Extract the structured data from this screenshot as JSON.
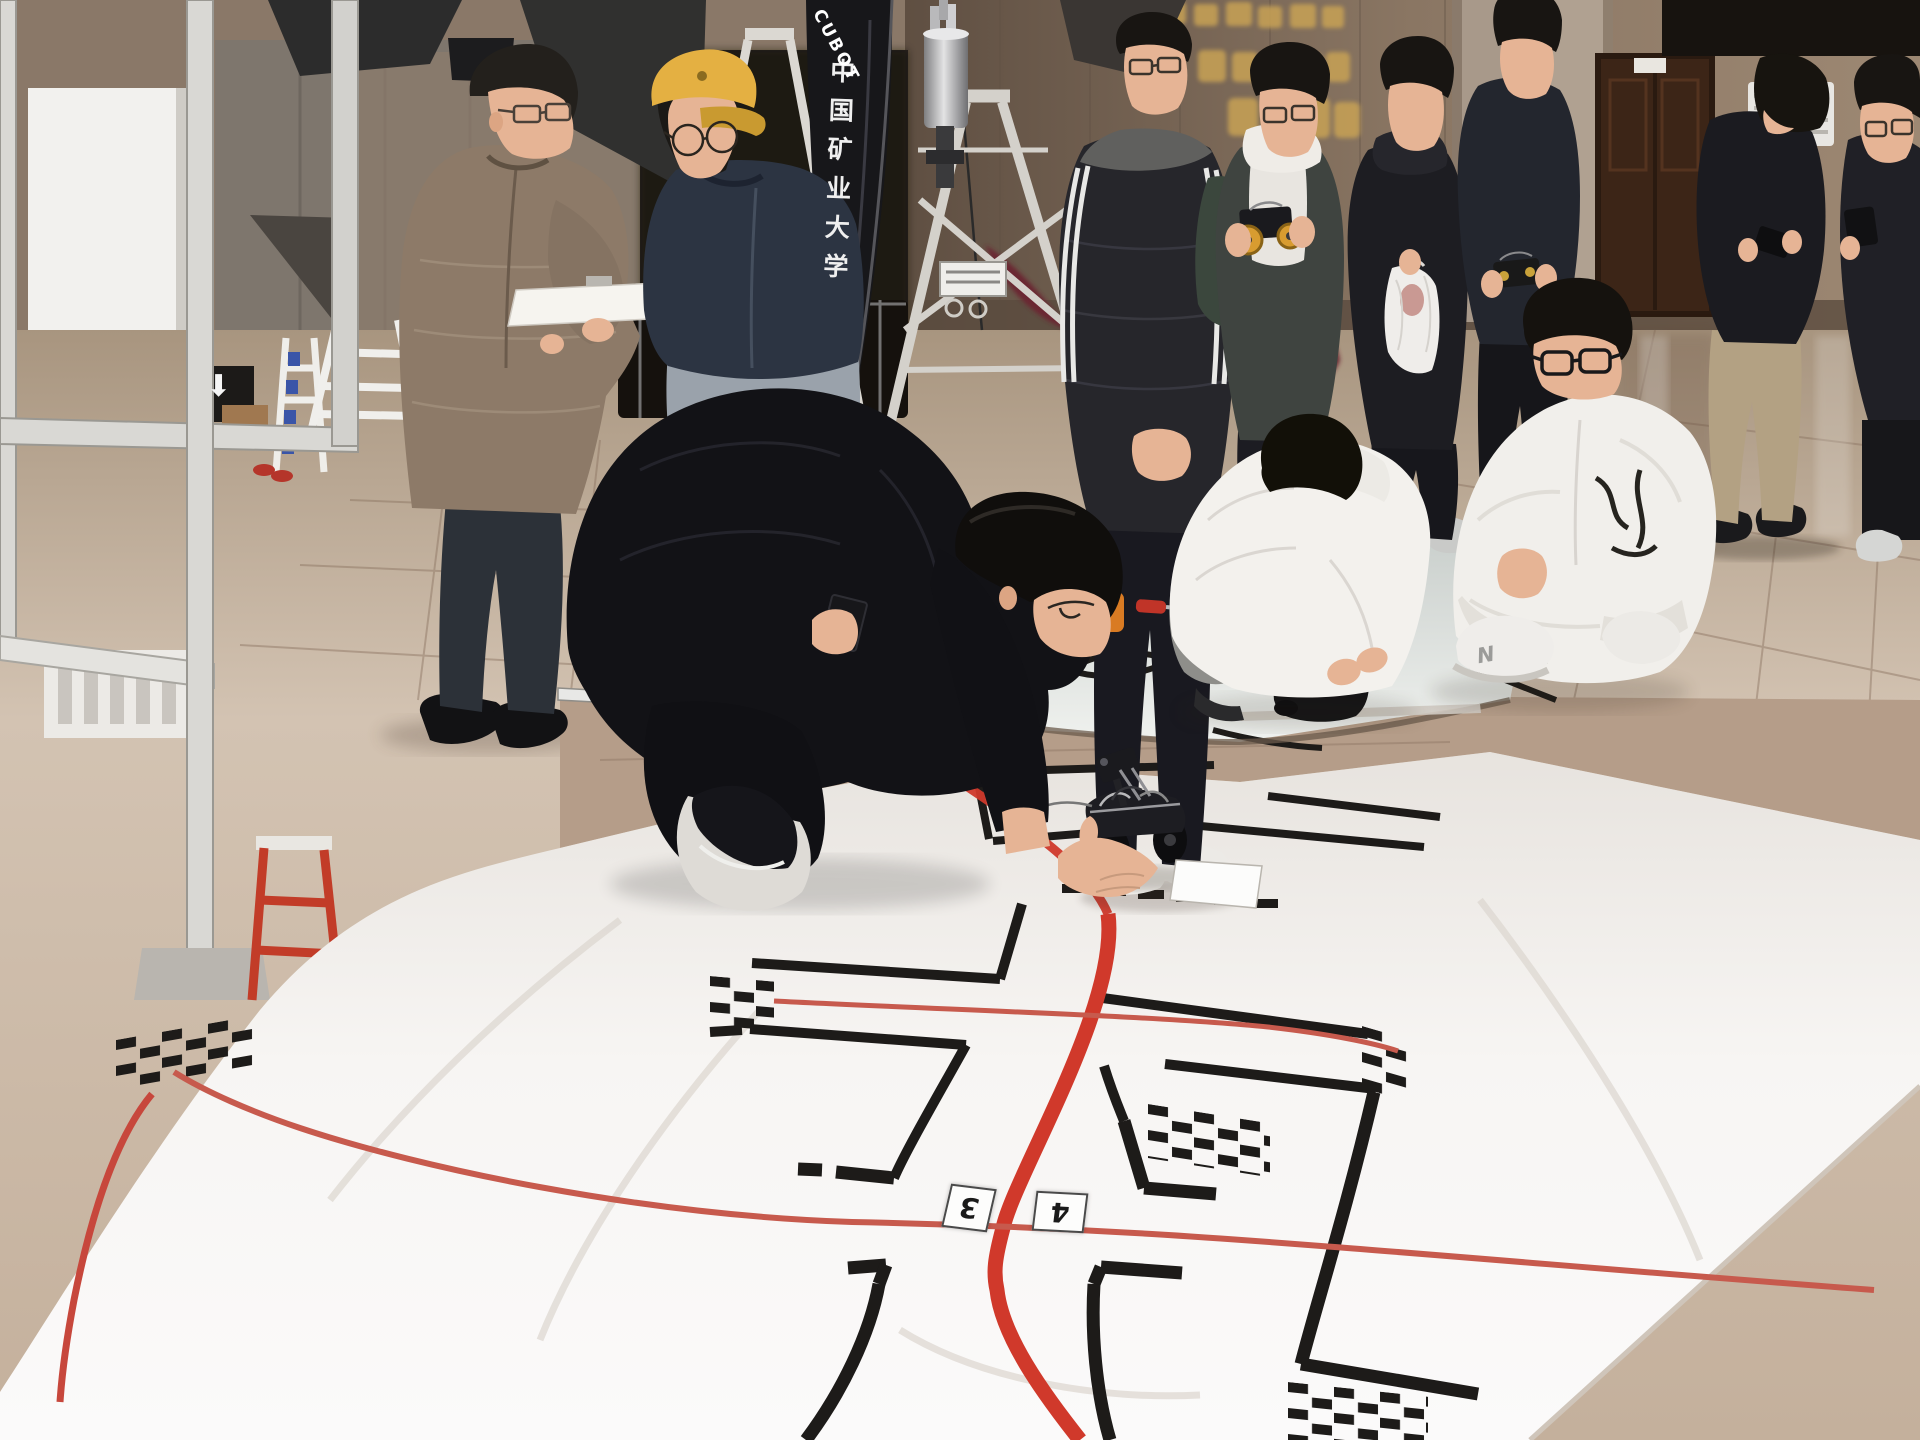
{
  "scene": {
    "type": "photograph",
    "subject": "Students and a judge at an indoor line-following robot competition practice hall",
    "banner": {
      "university_cn": "中国矿业大学",
      "team_en": "CUBOT"
    },
    "track_cards": {
      "card_left": "3",
      "card_right": "4"
    },
    "shoe_logo_letter": "N",
    "icons": {
      "down_arrow_sign": "⬇"
    }
  },
  "palette": {
    "floor1": "#b9a693",
    "floor2": "#dccdbd",
    "tileband": "#b59d89",
    "wall1": "#6e5d4f",
    "wall2": "#97836f",
    "alcove": "#261f19",
    "panel": "#7e766d",
    "whitewall": "#f2f1ee",
    "metal": "#d9d8d4",
    "truss": "#dbd8d2",
    "flag": "#17171a",
    "matA1": "#ccd2cf",
    "matA2": "#eff1ee",
    "matB1": "#e9e5e0",
    "matB2": "#fbfaf9",
    "track": "#1d1b19",
    "red": "#d0392b",
    "thinred": "#c75a4d",
    "skin": "#e6b495",
    "hair": "#181512",
    "teacher": "#8d7a68",
    "navy": "#2c3442",
    "dark": "#15151a",
    "whitecloth": "#f1efec",
    "graycloth": "#9aa2ab",
    "yellow": "#e4b042",
    "maroon": "#6b2531",
    "green": "#3b473d",
    "door": "#3c2517",
    "gold": "#c8a254",
    "card": "#fdfdfc"
  }
}
